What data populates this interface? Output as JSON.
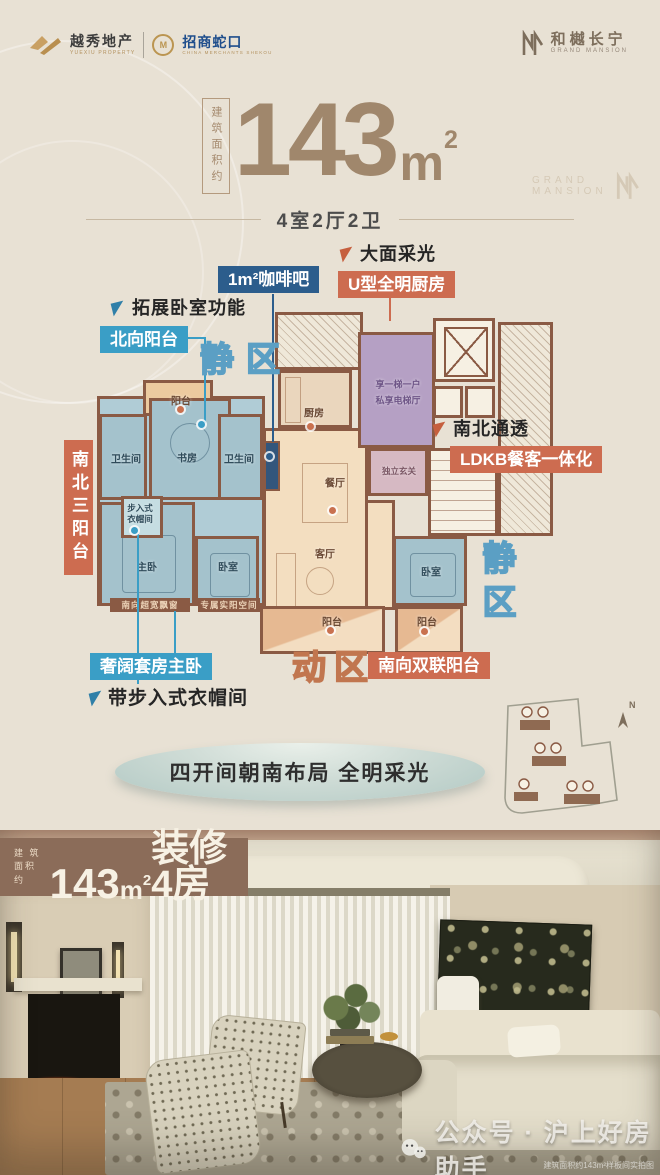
{
  "brand": {
    "yuexiu_cn": "越秀地产",
    "yuexiu_en": "YUEXIU PROPERTY",
    "shekou_mark": "M",
    "shekou_cn": "招商蛇口",
    "shekou_en": "CHINA MERCHANTS SHEKOU",
    "project_cn": "和樾长宁",
    "project_en": "GRAND MANSION",
    "faint_logo_l1": "GRAND",
    "faint_logo_l2": "MANSION"
  },
  "title": {
    "area_label": "建筑面积约",
    "num": "143",
    "unit": "m",
    "sup": "2",
    "layout": "4室2厅2卫"
  },
  "callouts": {
    "expand_bedroom": "拓展卧室功能",
    "north_balcony": "北向阳台",
    "coffee_bar": "1m²咖啡吧",
    "daylight": "大面采光",
    "u_kitchen": "U型全明厨房",
    "ns_through": "南北通透",
    "ldkb": "LDKB餐客一体化",
    "three_balconies": "南北三阳台",
    "master_suite": "奢阔套房主卧",
    "closet_note": "带步入式衣帽间",
    "south_double_balcony": "南向双联阳台",
    "zone_quiet": "静区",
    "zone_active": "动区"
  },
  "plan": {
    "rooms": {
      "balcony_north": "阳台",
      "bath_left": "卫生间",
      "study": "书房",
      "bath_mid": "卫生间",
      "kitchen": "厨房",
      "dining": "餐厅",
      "living": "客厅",
      "closet_l1": "步入式",
      "closet_l2": "衣帽间",
      "master": "主卧",
      "bedroom2": "卧室",
      "bedroom3": "卧室",
      "balcony_s1": "阳台",
      "balcony_s2": "阳台",
      "foyer": "独立玄关",
      "hall_l1": "享一梯一户",
      "hall_l2": "私享电梯厅",
      "strip1": "南向超宽飘窗",
      "strip2": "专属实阳空间"
    }
  },
  "banner": {
    "text": "四开间朝南布局 全明采光"
  },
  "siteplan": {
    "compass": "N"
  },
  "band": {
    "prefix_l1": "建 筑",
    "prefix_l2": "面积约",
    "num": "143",
    "unit": "m",
    "sup": "2",
    "suffix": "装修4房"
  },
  "photo": {
    "watermark": "公众号 · 沪上好房助手",
    "caption": "建筑面积约143m²样板间实拍图"
  },
  "colors": {
    "accent_orange": "#cd6c50",
    "accent_blue": "#3a9ec6",
    "accent_navy": "#2c5d8c",
    "wall_brown": "#8a5a44",
    "band_brown": "#8b6c59"
  }
}
